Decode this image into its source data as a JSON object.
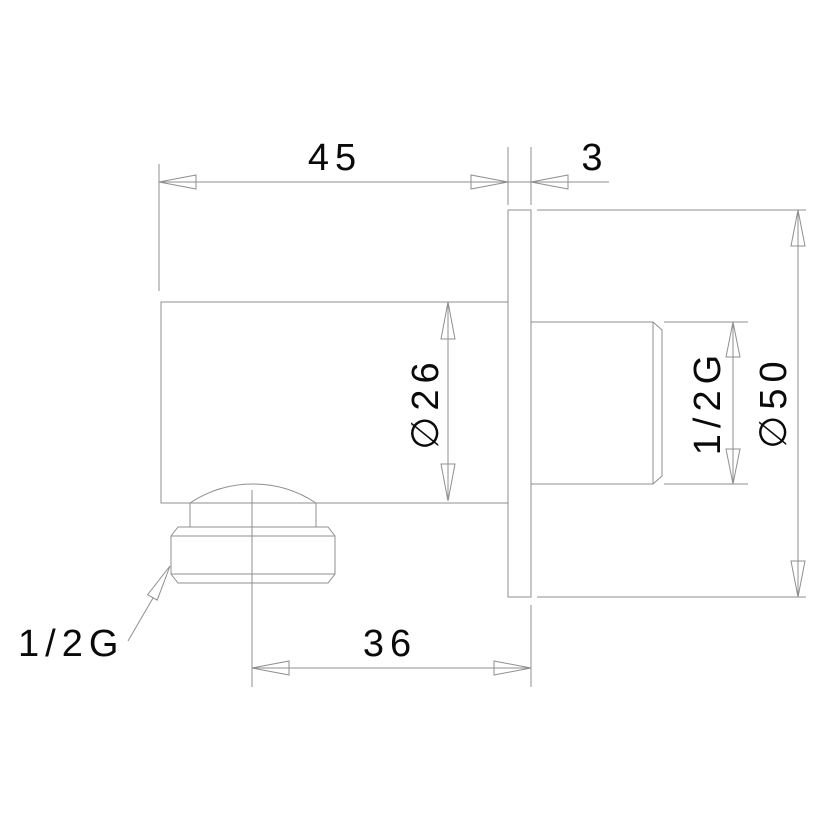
{
  "drawing": {
    "colors": {
      "line": "#8f8f8f",
      "text": "#000000",
      "background": "#ffffff"
    },
    "labels": {
      "body_length": "45",
      "plate_thickness": "3",
      "body_diameter": "∅26",
      "inlet_thread": "1/2G",
      "plate_diameter": "∅50",
      "outlet_offset": "36",
      "outlet_thread": "1/2G"
    }
  }
}
